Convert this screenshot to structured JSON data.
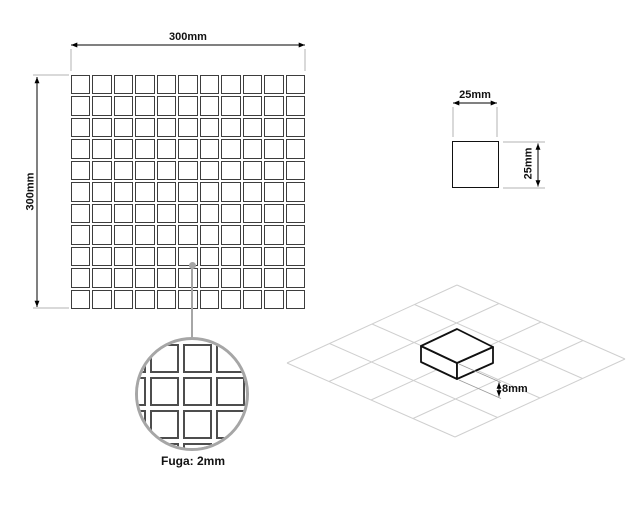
{
  "sheet": {
    "width_label": "300mm",
    "height_label": "300mm",
    "cols": 11,
    "rows": 11
  },
  "chip": {
    "width_label": "25mm",
    "height_label": "25mm"
  },
  "grout": {
    "label": "Fuga: 2mm",
    "detail_cols": 5,
    "detail_rows": 5
  },
  "iso": {
    "thickness_label": "8mm",
    "grid_cols": 4,
    "grid_rows": 4
  },
  "colors": {
    "line": "#000000",
    "tile_stroke": "#3d3d3d",
    "extension": "#b3b3b3",
    "detail": "#a6a6a6",
    "iso_grid": "#cfcfcf"
  }
}
